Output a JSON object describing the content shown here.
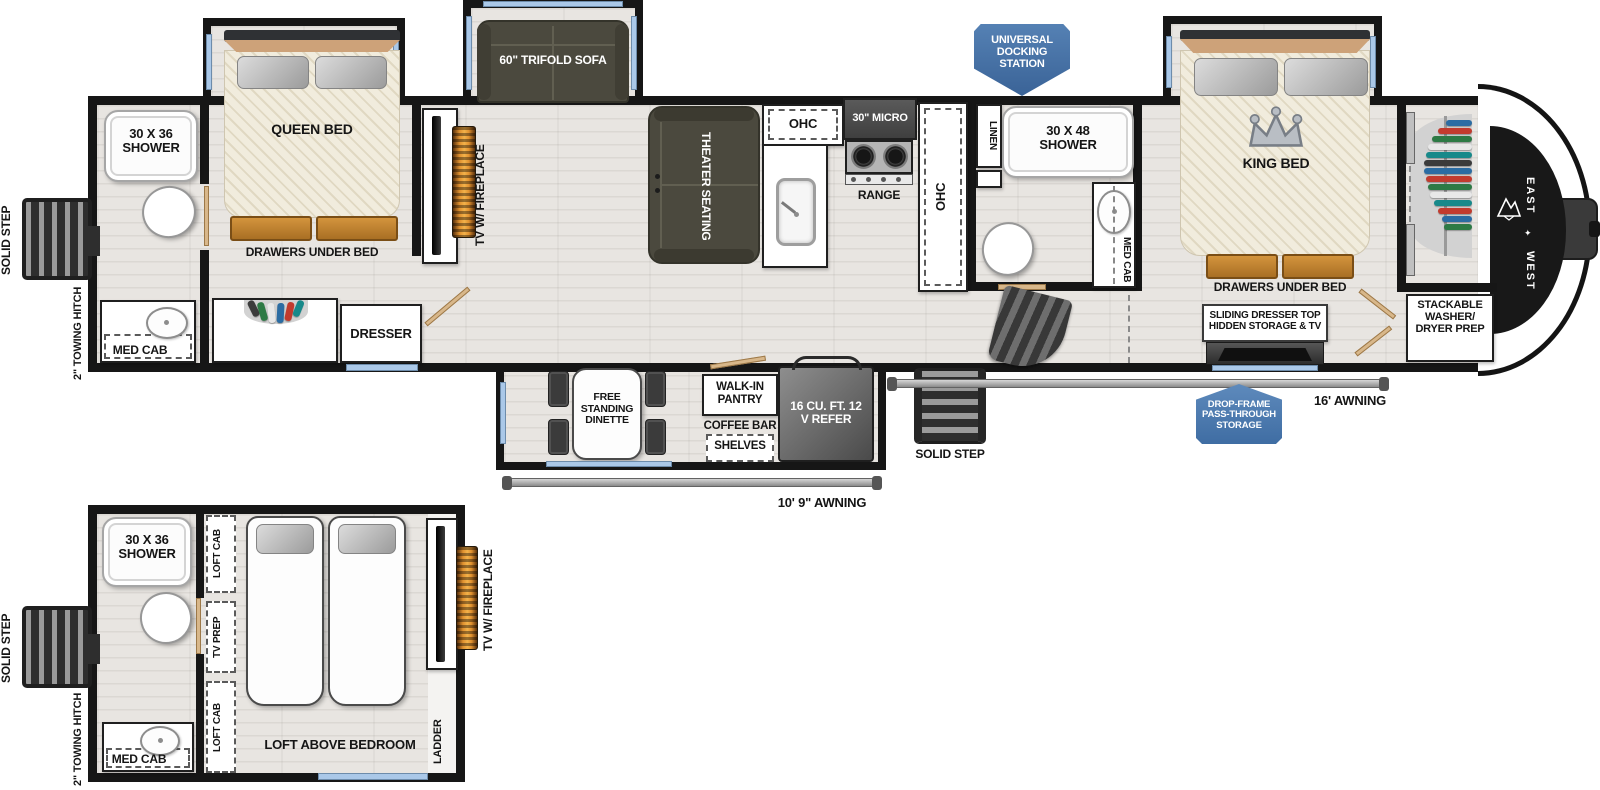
{
  "colors": {
    "wall": "#161616",
    "floor": "#e8e5e1",
    "badge_blue": "#4a77ab",
    "window_blue": "#aac8e8",
    "furniture_olive": "#4b493e",
    "drawer_wood": "#c8883a",
    "flame_orange": "#e0912f"
  },
  "brand": {
    "east": "EAST",
    "west": "WEST"
  },
  "labels": {
    "solid_step": "SOLID STEP",
    "towing_hitch": "2\" TOWING HITCH",
    "shower_30x36": "30 X 36 SHOWER",
    "shower_30x48": "30 X 48 SHOWER",
    "med_cab": "MED CAB",
    "queen_bed": "QUEEN BED",
    "king_bed": "KING BED",
    "drawers_under_bed": "DRAWERS UNDER BED",
    "dresser": "DRESSER",
    "tv_fireplace": "TV W/ FIREPLACE",
    "trifold_sofa": "60\" TRIFOLD SOFA",
    "theater_seating": "THEATER SEATING",
    "ohc": "OHC",
    "micro": "30\" MICRO",
    "range": "RANGE",
    "linen": "LINEN",
    "docking_station": "UNIVERSAL DOCKING STATION",
    "sliding_dresser": "SLIDING DRESSER TOP HIDDEN STORAGE & TV",
    "washer_dryer": "STACKABLE WASHER/ DRYER PREP",
    "dinette": "FREE STANDING DINETTE",
    "pantry": "WALK-IN PANTRY",
    "coffee_bar": "COFFEE BAR",
    "shelves": "SHELVES",
    "refer": "16 CU. FT. 12 V REFER",
    "awning_10": "10' 9\" AWNING",
    "awning_16": "16' AWNING",
    "drop_frame": "DROP-FRAME PASS-THROUGH STORAGE",
    "loft_cab": "LOFT CAB",
    "tv_prep": "TV PREP",
    "loft_above_bedroom": "LOFT ABOVE BEDROOM",
    "ladder": "LADDER"
  }
}
